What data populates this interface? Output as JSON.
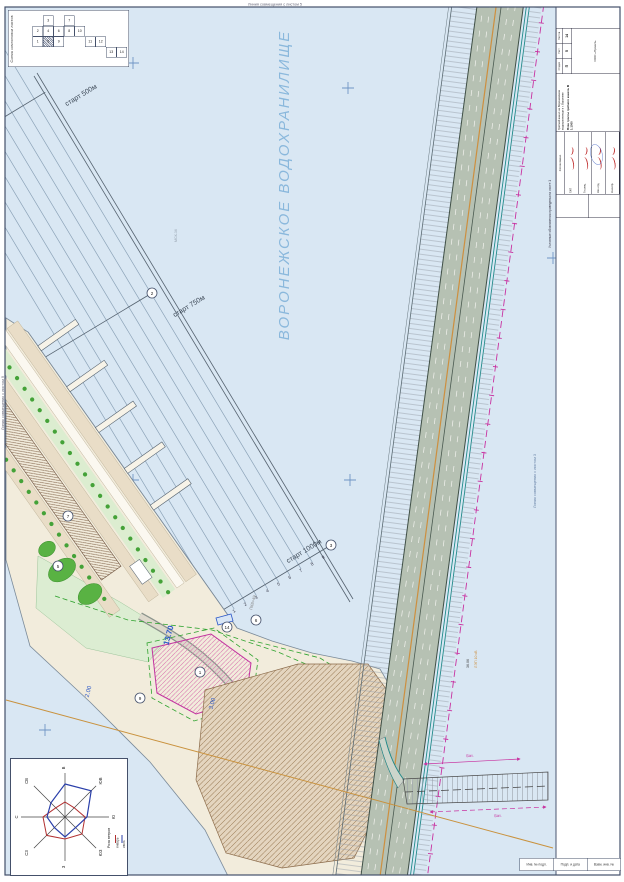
{
  "scheme": {
    "title": "Схема компоновки листов",
    "sheets": [
      {
        "num": "3"
      },
      {
        "num": "7"
      },
      {
        "num": "2"
      },
      {
        "num": "4"
      },
      {
        "num": "6"
      },
      {
        "num": "8"
      },
      {
        "num": "10"
      },
      {
        "num": "1"
      },
      {
        "num": "5",
        "current": true
      },
      {
        "num": "9"
      },
      {
        "num": "11"
      },
      {
        "num": "12"
      },
      {
        "num": "13"
      },
      {
        "num": "14"
      }
    ]
  },
  "edges": {
    "top": "Линия совмещения с листом 5",
    "left": "Линия совмещения с листом 9",
    "inner": "Линия совмещения с листом 3"
  },
  "water": {
    "name": "ВОРОНЕЖСКОЕ ВОДОХРАНИЛИЩЕ"
  },
  "course": {
    "start_500": "старт 500м",
    "start_750": "старт 750м",
    "start_1000": "старт 1000м",
    "lane_numbers": [
      "1",
      "2",
      "3",
      "4",
      "5",
      "6",
      "7",
      "8",
      "9"
    ]
  },
  "ann": {
    "elev_main": "13.70",
    "elev_a": "3.00",
    "elev_b": "2.00",
    "pk": "ПК8+49",
    "coord": "МСК-36",
    "power_a": "36.06",
    "power_b": "ЛЭП 10 кВ",
    "dim_a": "Бат.",
    "dim_b": "Бат."
  },
  "callouts": [
    "1",
    "2",
    "3",
    "5",
    "6",
    "7",
    "9",
    "14"
  ],
  "wind": {
    "title": "Роза ветров",
    "dirs": [
      "В",
      "ЮВ",
      "Ю",
      "ЮЗ",
      "З",
      "СЗ",
      "С",
      "СВ"
    ],
    "legend": [
      {
        "label": "январь",
        "color": "#b23030"
      },
      {
        "label": "июль",
        "color": "#2a3faa"
      }
    ],
    "values_jan": [
      15,
      13,
      20,
      24,
      22,
      26,
      22,
      13
    ],
    "values_jul": [
      33,
      37,
      22,
      15,
      20,
      15,
      18,
      20
    ]
  },
  "tb": {
    "note": "Условные обозначения приведены на листе 1",
    "agree_label": "Согласовано",
    "approval": [
      {
        "label": "ГИП"
      },
      {
        "label": "Гл.спец."
      },
      {
        "label": "Нач.отд."
      },
      {
        "label": "Н.контр."
      }
    ],
    "project": "Гребной канал на Воронежском водохранилище в г. Воронеже",
    "doc": "План трассы гребного канала. М 1:1000",
    "stage_label": "Стадия",
    "stage": "П",
    "sheet_label": "Лист",
    "sheet": "5",
    "sheets_label": "Листов",
    "sheets": "14",
    "org": "ООО «Проект»"
  },
  "strip": {
    "cells": [
      "Инв. № подл.",
      "Подп. и дата",
      "Взам. инв. №"
    ]
  }
}
